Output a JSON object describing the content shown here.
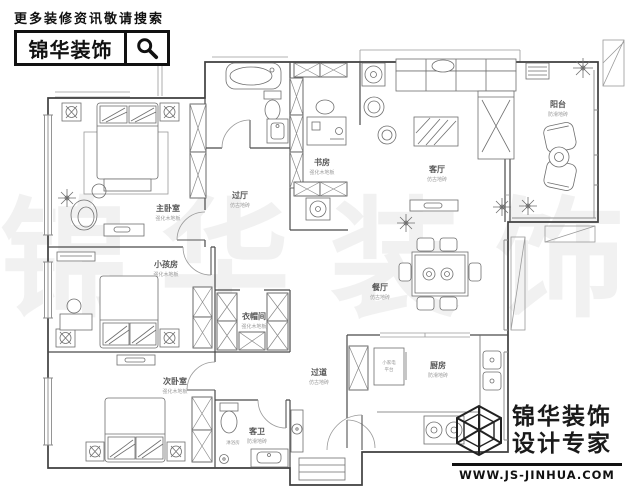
{
  "search_banner": {
    "promo_text": "更多装修资讯敬请搜索",
    "brand": "锦华装饰"
  },
  "watermark": {
    "char1": "锦",
    "char2": "华",
    "char3": "装",
    "char4": "饰"
  },
  "rooms": {
    "master_bedroom": {
      "name": "主卧室",
      "finish": "强化木地板"
    },
    "kids_room": {
      "name": "小孩房",
      "finish": "强化木地板"
    },
    "second_bedroom": {
      "name": "次卧室",
      "finish": "强化木地板"
    },
    "cloakroom": {
      "name": "衣帽间",
      "finish": "强化木地板"
    },
    "study": {
      "name": "书房",
      "finish": "强化木地板"
    },
    "hall": {
      "name": "过厅",
      "finish": "仿古地砖"
    },
    "corridor": {
      "name": "过道",
      "finish": "仿古地砖"
    },
    "living_room": {
      "name": "客厅",
      "finish": "仿古地砖"
    },
    "dining_room": {
      "name": "餐厅",
      "finish": "仿古地砖"
    },
    "kitchen": {
      "name": "厨房",
      "finish": "防滑地砖"
    },
    "guest_bath": {
      "name": "客卫",
      "finish": "防滑地砖"
    },
    "balcony": {
      "name": "阳台",
      "finish": "防滑地砖"
    }
  },
  "annotations": {
    "shower": "淋浴房",
    "island_line1": "小家电",
    "island_line2": "平台"
  },
  "footer_logo": {
    "brand": "锦华装饰",
    "tagline": "设计专家",
    "url": "WWW.JS-JINHUA.COM"
  }
}
